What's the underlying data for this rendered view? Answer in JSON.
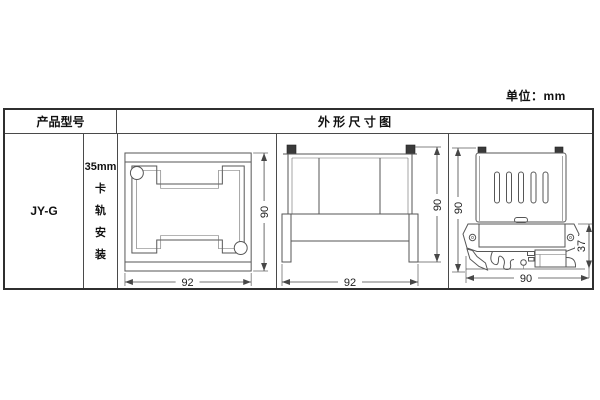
{
  "page": {
    "unit_label": "单位：mm"
  },
  "table": {
    "header": {
      "product_model": "产品型号",
      "outline_drawing": "外 形 尺 寸 图"
    },
    "row": {
      "model": "JY-G",
      "mounting": {
        "size": "35mm",
        "chars": [
          "卡",
          "轨",
          "安",
          "装"
        ]
      }
    }
  },
  "drawings": {
    "front_view": {
      "width": "92",
      "height": "90"
    },
    "side_view": {
      "width": "92",
      "height": "90"
    },
    "rail_view": {
      "bottom_width": "90",
      "height": "90",
      "rail_depth": "37"
    }
  },
  "colors": {
    "line": "#565656",
    "border": "#2f2f2f",
    "text": "#111111",
    "dim_text": "#222222"
  }
}
